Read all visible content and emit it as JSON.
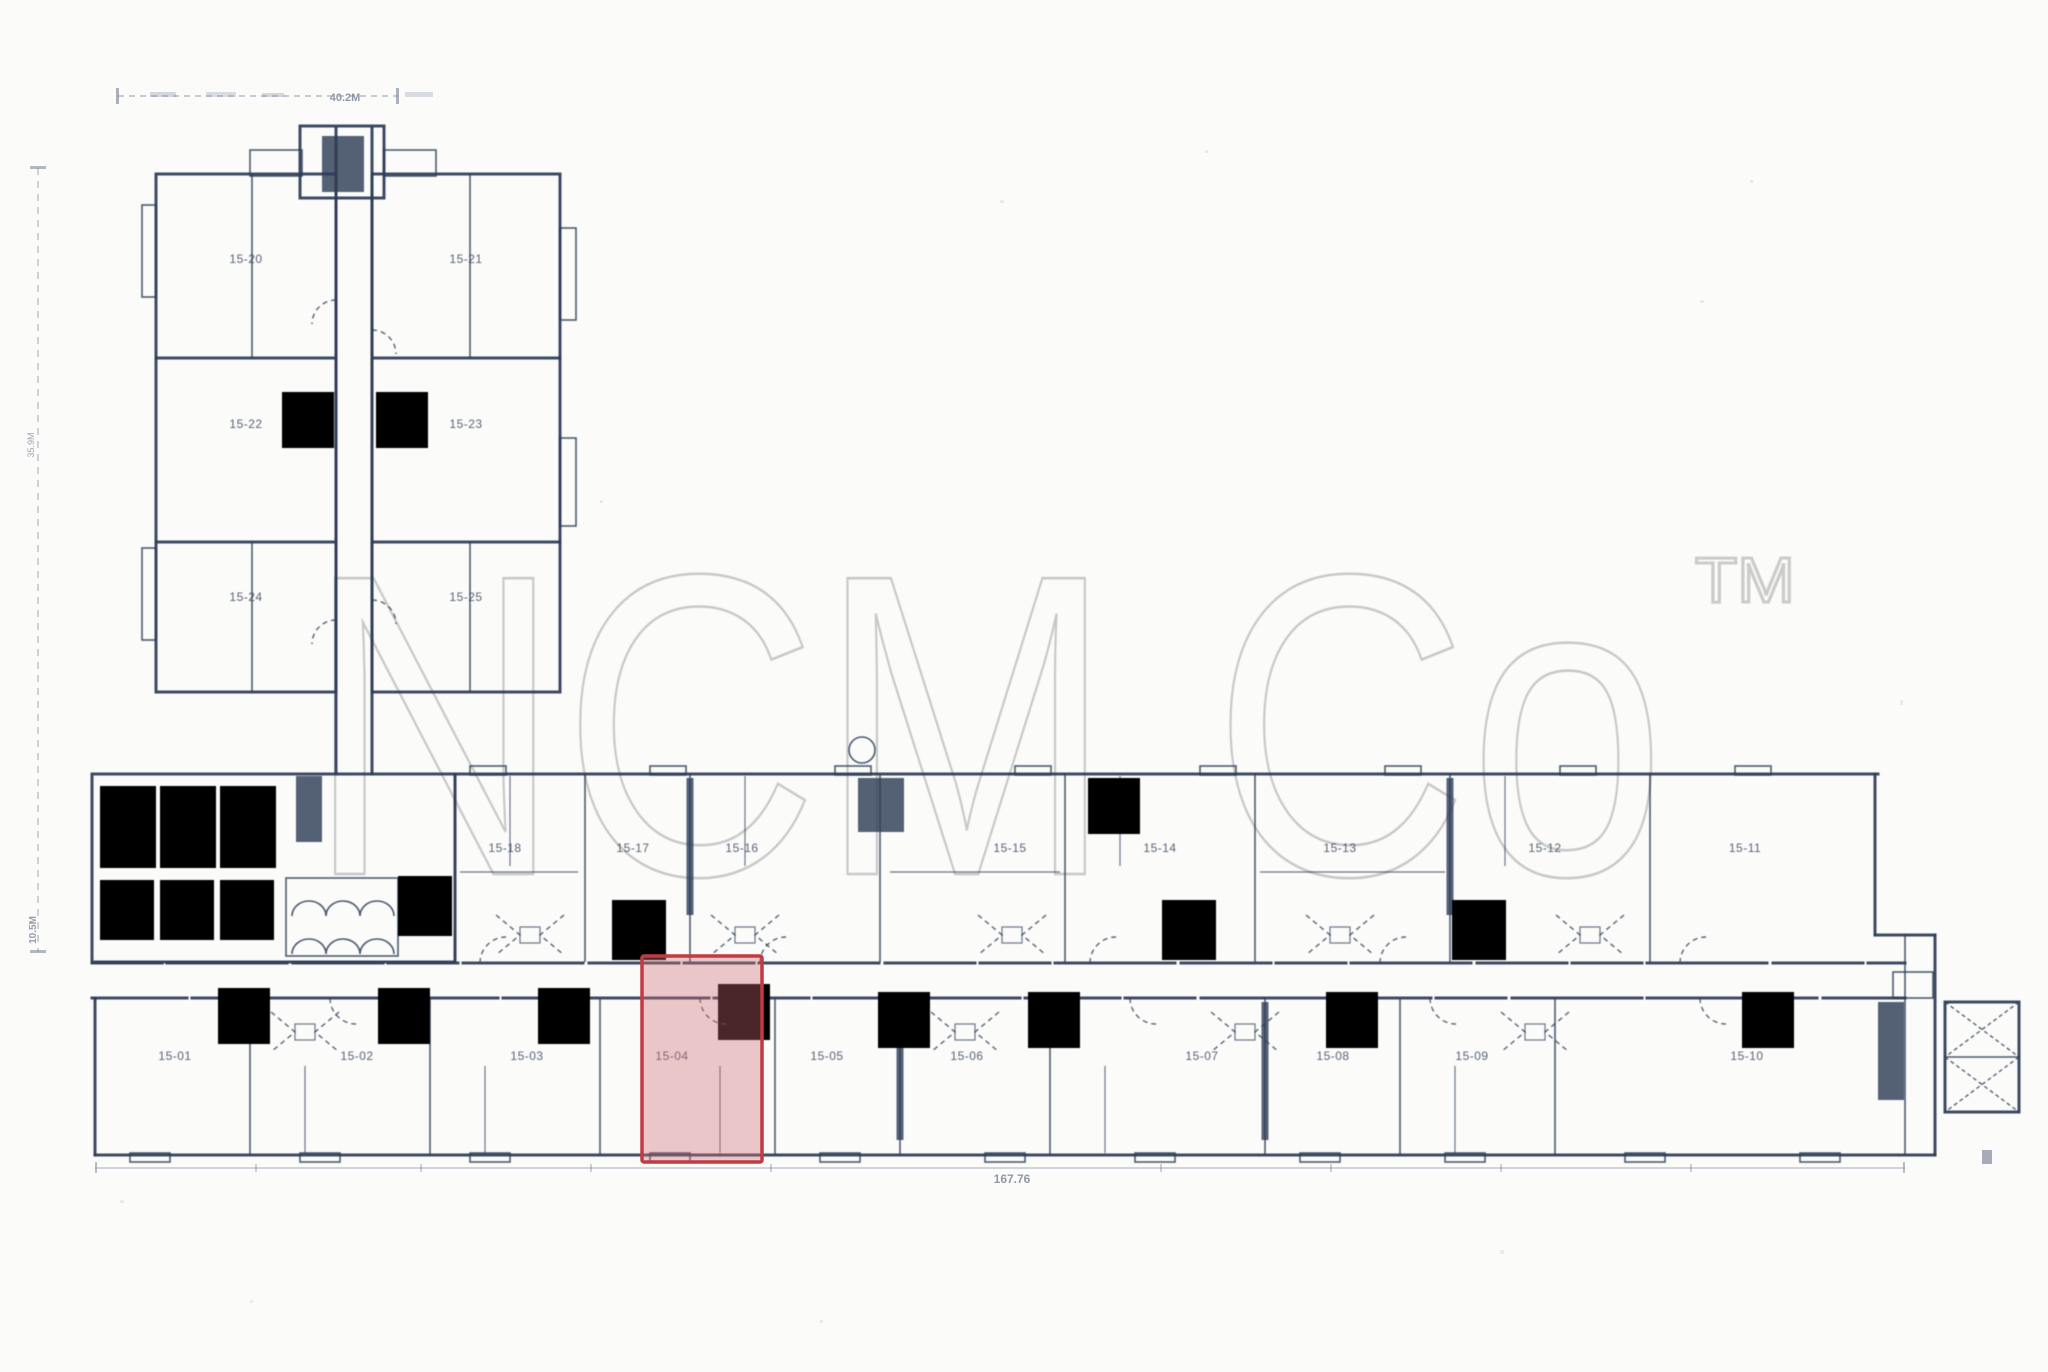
{
  "watermark": {
    "text": "NCM Co",
    "trademark": "TM"
  },
  "colors": {
    "ink": "#2e3d57",
    "paper": "#fbfbf9",
    "watermark": "#c6c6c6",
    "dimension": "#54617a",
    "highlight_fill": "#d06a72",
    "highlight_border": "#c23a42"
  },
  "highlight": {
    "unit_label": "15-04"
  },
  "units": {
    "tower": [
      "15-20",
      "15-21",
      "15-22",
      "15-23",
      "15-24",
      "15-25"
    ],
    "wing_upper": [
      "15-18",
      "15-17",
      "15-16",
      "15-15",
      "15-14",
      "15-13",
      "15-12",
      "15-11"
    ],
    "wing_lower": [
      "15-01",
      "15-02",
      "15-03",
      "15-04",
      "15-05",
      "15-06",
      "15-07",
      "15-08",
      "15-09",
      "15-10"
    ]
  },
  "dimensions": {
    "top": "40.2M",
    "left_upper": "35.9M",
    "left_lower": "10.5M",
    "bottom": "167.76"
  }
}
